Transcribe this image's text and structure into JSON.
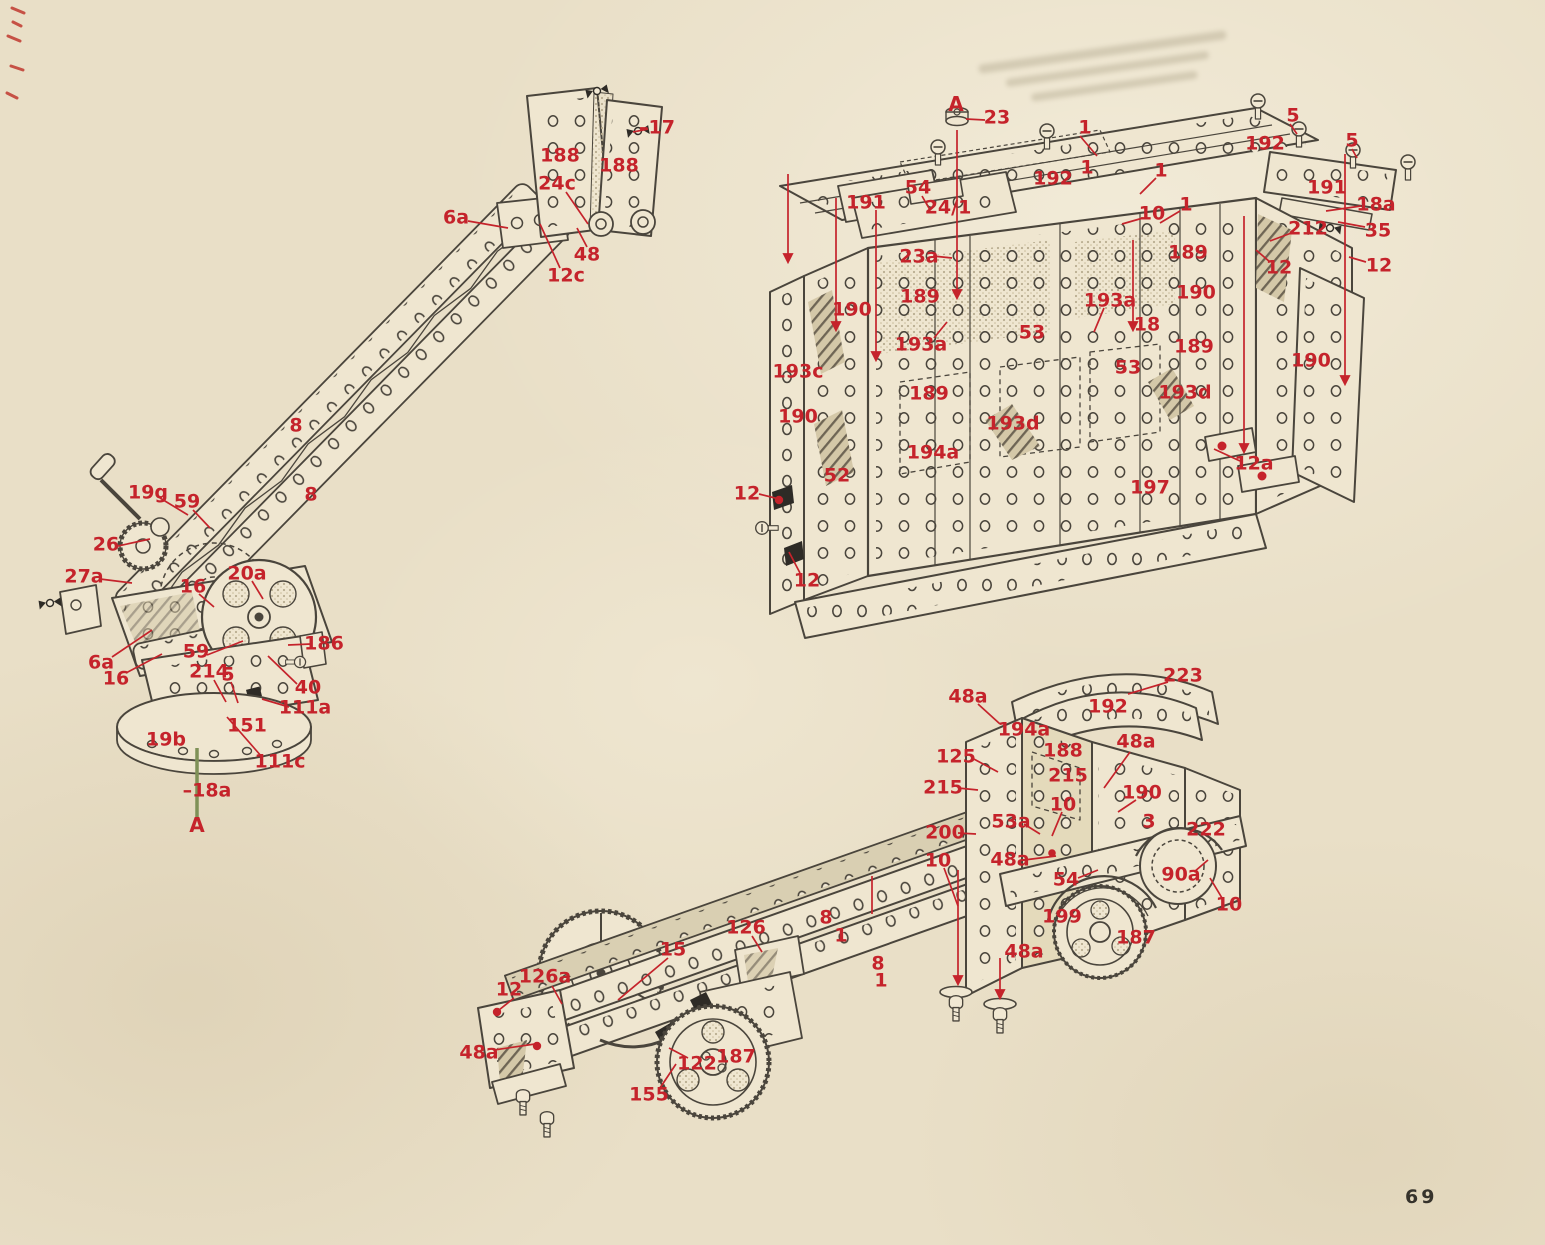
{
  "page": {
    "number": "69",
    "paper_color": "#e9dfc7",
    "label_color": "#c5232b",
    "ink_color": "#46413a"
  },
  "figures": [
    {
      "name": "crane-jib-unit",
      "labels": [
        {
          "t": "188",
          "x": 560,
          "y": 156
        },
        {
          "t": "188",
          "x": 619,
          "y": 166
        },
        {
          "t": "–17",
          "x": 657,
          "y": 128
        },
        {
          "t": "24c",
          "x": 557,
          "y": 184
        },
        {
          "t": "48",
          "x": 587,
          "y": 255
        },
        {
          "t": "12c",
          "x": 566,
          "y": 276
        },
        {
          "t": "6a",
          "x": 456,
          "y": 218
        },
        {
          "t": "8",
          "x": 296,
          "y": 426
        },
        {
          "t": "8",
          "x": 311,
          "y": 495
        },
        {
          "t": "19g",
          "x": 148,
          "y": 493
        },
        {
          "t": "59",
          "x": 187,
          "y": 502
        },
        {
          "t": "26",
          "x": 106,
          "y": 545
        },
        {
          "t": "27a",
          "x": 84,
          "y": 577
        },
        {
          "t": "16",
          "x": 193,
          "y": 587
        },
        {
          "t": "20a",
          "x": 247,
          "y": 574
        },
        {
          "t": "186",
          "x": 324,
          "y": 644
        },
        {
          "t": "6a",
          "x": 101,
          "y": 663
        },
        {
          "t": "59",
          "x": 196,
          "y": 652
        },
        {
          "t": "16",
          "x": 116,
          "y": 679
        },
        {
          "t": "214",
          "x": 209,
          "y": 672
        },
        {
          "t": "5",
          "x": 228,
          "y": 675
        },
        {
          "t": "40",
          "x": 308,
          "y": 688
        },
        {
          "t": "111a",
          "x": 305,
          "y": 708
        },
        {
          "t": "19b",
          "x": 166,
          "y": 740
        },
        {
          "t": "151",
          "x": 247,
          "y": 726
        },
        {
          "t": "111c",
          "x": 280,
          "y": 762
        },
        {
          "t": "–18a",
          "x": 207,
          "y": 791
        },
        {
          "t": "A",
          "x": 197,
          "y": 825,
          "cls": "letter"
        }
      ]
    },
    {
      "name": "van-body-unit",
      "labels": [
        {
          "t": "A",
          "x": 956,
          "y": 104,
          "cls": "letter"
        },
        {
          "t": "23",
          "x": 997,
          "y": 118
        },
        {
          "t": "1",
          "x": 1085,
          "y": 128
        },
        {
          "t": "5",
          "x": 1293,
          "y": 116
        },
        {
          "t": "192",
          "x": 1265,
          "y": 144
        },
        {
          "t": "5",
          "x": 1352,
          "y": 141
        },
        {
          "t": "192",
          "x": 1053,
          "y": 179
        },
        {
          "t": "191",
          "x": 866,
          "y": 203
        },
        {
          "t": "54",
          "x": 918,
          "y": 188
        },
        {
          "t": "24/1",
          "x": 948,
          "y": 208
        },
        {
          "t": "1",
          "x": 1087,
          "y": 168
        },
        {
          "t": "1",
          "x": 1161,
          "y": 171
        },
        {
          "t": "10",
          "x": 1152,
          "y": 214
        },
        {
          "t": "1",
          "x": 1186,
          "y": 205
        },
        {
          "t": "191",
          "x": 1327,
          "y": 188
        },
        {
          "t": "18a",
          "x": 1376,
          "y": 205
        },
        {
          "t": "35",
          "x": 1378,
          "y": 231
        },
        {
          "t": "212",
          "x": 1308,
          "y": 229
        },
        {
          "t": "12",
          "x": 1279,
          "y": 268
        },
        {
          "t": "12",
          "x": 1379,
          "y": 266
        },
        {
          "t": "23a",
          "x": 919,
          "y": 257
        },
        {
          "t": "189",
          "x": 1188,
          "y": 253
        },
        {
          "t": "189",
          "x": 920,
          "y": 297
        },
        {
          "t": "190",
          "x": 852,
          "y": 310
        },
        {
          "t": "193a",
          "x": 1110,
          "y": 301
        },
        {
          "t": "190",
          "x": 1196,
          "y": 293
        },
        {
          "t": "53",
          "x": 1032,
          "y": 333
        },
        {
          "t": "18",
          "x": 1147,
          "y": 325
        },
        {
          "t": "193a",
          "x": 921,
          "y": 345
        },
        {
          "t": "189",
          "x": 1194,
          "y": 347
        },
        {
          "t": "193c",
          "x": 798,
          "y": 372
        },
        {
          "t": "53",
          "x": 1128,
          "y": 368
        },
        {
          "t": "189",
          "x": 929,
          "y": 394
        },
        {
          "t": "193d",
          "x": 1185,
          "y": 393
        },
        {
          "t": "190",
          "x": 1311,
          "y": 361
        },
        {
          "t": "193d",
          "x": 1013,
          "y": 424
        },
        {
          "t": "190",
          "x": 798,
          "y": 417
        },
        {
          "t": "52",
          "x": 837,
          "y": 476
        },
        {
          "t": "194a",
          "x": 933,
          "y": 453
        },
        {
          "t": "12a",
          "x": 1254,
          "y": 464
        },
        {
          "t": "197",
          "x": 1150,
          "y": 488
        },
        {
          "t": "12",
          "x": 747,
          "y": 494
        },
        {
          "t": "12",
          "x": 807,
          "y": 581
        }
      ]
    },
    {
      "name": "chassis-unit",
      "labels": [
        {
          "t": "48a",
          "x": 968,
          "y": 697
        },
        {
          "t": "223",
          "x": 1183,
          "y": 676
        },
        {
          "t": "192",
          "x": 1108,
          "y": 707
        },
        {
          "t": "194a",
          "x": 1024,
          "y": 730
        },
        {
          "t": "188",
          "x": 1063,
          "y": 751
        },
        {
          "t": "48a",
          "x": 1136,
          "y": 742
        },
        {
          "t": "125",
          "x": 956,
          "y": 757
        },
        {
          "t": "215",
          "x": 1068,
          "y": 776
        },
        {
          "t": "215",
          "x": 943,
          "y": 788
        },
        {
          "t": "190",
          "x": 1142,
          "y": 793
        },
        {
          "t": "10",
          "x": 1063,
          "y": 805
        },
        {
          "t": "53a",
          "x": 1011,
          "y": 822
        },
        {
          "t": "200",
          "x": 945,
          "y": 833
        },
        {
          "t": "222",
          "x": 1206,
          "y": 830
        },
        {
          "t": "3",
          "x": 1149,
          "y": 822
        },
        {
          "t": "10",
          "x": 938,
          "y": 861
        },
        {
          "t": "48a",
          "x": 1010,
          "y": 860
        },
        {
          "t": "54",
          "x": 1066,
          "y": 880
        },
        {
          "t": "90a",
          "x": 1181,
          "y": 875
        },
        {
          "t": "10",
          "x": 1229,
          "y": 905
        },
        {
          "t": "199",
          "x": 1062,
          "y": 917
        },
        {
          "t": "187",
          "x": 1136,
          "y": 938
        },
        {
          "t": "48a",
          "x": 1024,
          "y": 952
        },
        {
          "t": "126",
          "x": 746,
          "y": 928
        },
        {
          "t": "8",
          "x": 826,
          "y": 918
        },
        {
          "t": "1",
          "x": 841,
          "y": 936
        },
        {
          "t": "8",
          "x": 878,
          "y": 964
        },
        {
          "t": "1",
          "x": 881,
          "y": 981
        },
        {
          "t": "15",
          "x": 673,
          "y": 950
        },
        {
          "t": "126a",
          "x": 545,
          "y": 977
        },
        {
          "t": "12",
          "x": 509,
          "y": 990
        },
        {
          "t": "48a",
          "x": 479,
          "y": 1053
        },
        {
          "t": "122",
          "x": 697,
          "y": 1064
        },
        {
          "t": "187",
          "x": 736,
          "y": 1057
        },
        {
          "t": "155",
          "x": 649,
          "y": 1095
        }
      ]
    }
  ]
}
